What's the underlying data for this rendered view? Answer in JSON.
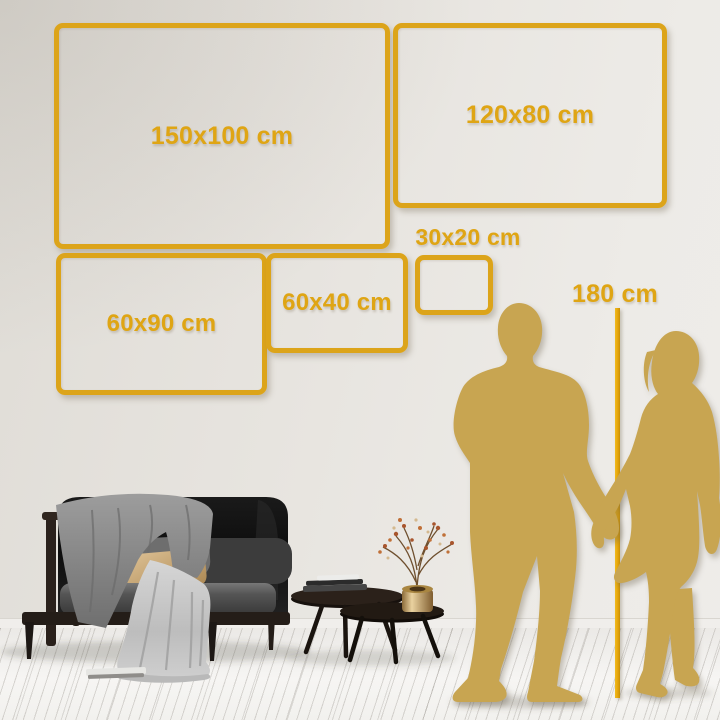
{
  "image_type": "wall-art size comparison guide",
  "unit": "cm",
  "frames": [
    {
      "label": "150x100 cm",
      "width_cm": 150,
      "height_cm": 100
    },
    {
      "label": "120x80 cm",
      "width_cm": 120,
      "height_cm": 80
    },
    {
      "label": "60x90 cm",
      "width_cm": 60,
      "height_cm": 90
    },
    {
      "label": "60x40 cm",
      "width_cm": 60,
      "height_cm": 40
    },
    {
      "label": "30x20 cm",
      "width_cm": 30,
      "height_cm": 20
    }
  ],
  "reference": {
    "label": "180 cm",
    "height_cm": 180,
    "depicts": "couple-silhouette-height-ruler"
  },
  "colors": {
    "accent_gold": "#DFA514",
    "line_gold": "#E2A30A",
    "silhouette_gold": "#C8A551",
    "wall": "#E8E5E0",
    "floor": "#F3F2EF"
  },
  "scene_items": [
    "man-silhouette",
    "woman-silhouette",
    "sofa-with-blankets",
    "nesting-coffee-tables",
    "books",
    "brass-vase-with-dried-flowers",
    "plank-floor"
  ]
}
